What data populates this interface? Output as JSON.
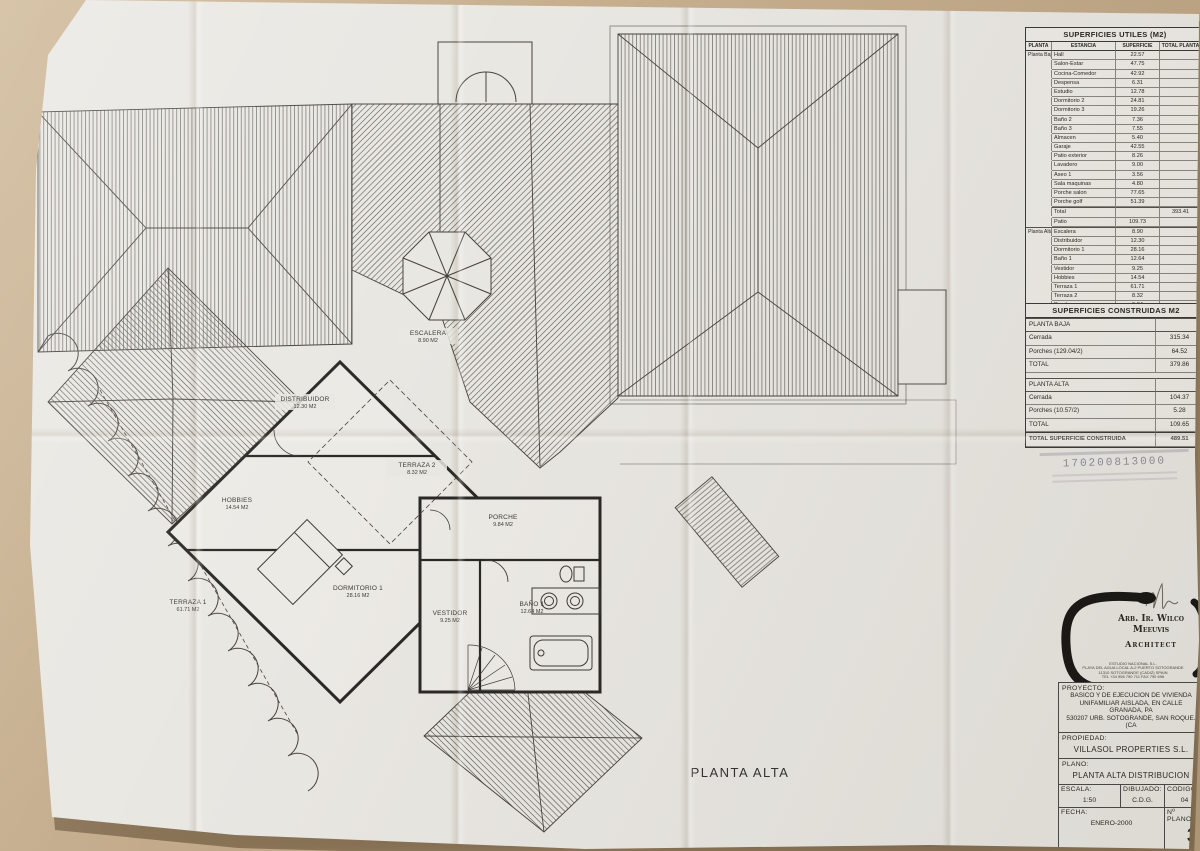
{
  "photo": {
    "background": "#c3ab8b",
    "paper": "#e9e7e2",
    "ink": "#45423c",
    "wall_ink": "#2b2926",
    "stamp_color": "#525470"
  },
  "plan": {
    "caption": "PLANTA ALTA",
    "rooms": [
      {
        "name": "DISTRIBUIDOR",
        "area": "12.30 M2"
      },
      {
        "name": "ESCALERA",
        "area": "8.90 M2"
      },
      {
        "name": "TERRAZA 2",
        "area": "8.32 M2"
      },
      {
        "name": "HOBBIES",
        "area": "14.54 M2"
      },
      {
        "name": "PORCHE",
        "area": "9.84 M2"
      },
      {
        "name": "DORMITORIO 1",
        "area": "28.16 M2"
      },
      {
        "name": "VESTIDOR",
        "area": "9.25 M2"
      },
      {
        "name": "BAÑO 1",
        "area": "12.64 M2"
      },
      {
        "name": "TERRAZA 1",
        "area": "61.71 M2"
      }
    ]
  },
  "superficies_utiles": {
    "title": "SUPERFICIES UTILES (M2)",
    "col_planta": "PLANTA",
    "col_estancia": "ESTANCIA",
    "col_superficie": "SUPERFICIE",
    "col_total": "TOTAL PLANTA",
    "planta_baja_label": "Planta Baja",
    "pb": [
      [
        "Hall",
        "22.57"
      ],
      [
        "Salon-Estar",
        "47.75"
      ],
      [
        "Cocina-Comedor",
        "42.92"
      ],
      [
        "Despensa",
        "6.31"
      ],
      [
        "Estudio",
        "12.78"
      ],
      [
        "Dormitorio 2",
        "24.81"
      ],
      [
        "Dormitorio 3",
        "19.26"
      ],
      [
        "Baño 2",
        "7.36"
      ],
      [
        "Baño 3",
        "7.55"
      ],
      [
        "Almacen",
        "5.40"
      ],
      [
        "Garaje",
        "42.55"
      ],
      [
        "Patio exterior",
        "8.26"
      ],
      [
        "Lavadero",
        "9.00"
      ],
      [
        "Aseo 1",
        "3.56"
      ],
      [
        "Sala maquinas",
        "4.80"
      ],
      [
        "Porche salon",
        "77.65"
      ],
      [
        "Porche golf",
        "51.39"
      ]
    ],
    "pb_total_label": "Total",
    "pb_total": "393.41",
    "patio_label": "Patio",
    "patio": "109.73",
    "planta_alta_label": "Planta Alta",
    "pa": [
      [
        "Escalera",
        "8.90"
      ],
      [
        "Distribuidor",
        "12.30"
      ],
      [
        "Dormitorio 1",
        "28.16"
      ],
      [
        "Baño 1",
        "12.64"
      ],
      [
        "Vestidor",
        "9.25"
      ],
      [
        "Hobbies",
        "14.54"
      ],
      [
        "Terraza 1",
        "61.71"
      ],
      [
        "Terraza 2",
        "8.32"
      ],
      [
        "Porche",
        "9.84"
      ]
    ],
    "pa_total_label": "Total",
    "pa_total": "165.66",
    "grand_label": "TOTAL SUPERFICIES UTILES",
    "grand": "553.18"
  },
  "superficies_construidas": {
    "title": "SUPERFICIES CONSTRUIDAS M2",
    "pb_header": "PLANTA BAJA",
    "pb_rows": [
      [
        "Cerrada",
        "315.34"
      ],
      [
        "Porches  (129.04/2)",
        "64.52"
      ]
    ],
    "pb_total_label": "TOTAL",
    "pb_total": "379.86",
    "pa_header": "PLANTA ALTA",
    "pa_rows": [
      [
        "Cerrada",
        "104.37"
      ],
      [
        "Porches  (10.57/2)",
        "5.28"
      ]
    ],
    "pa_total_label": "TOTAL",
    "pa_total": "109.65",
    "grand_label": "TOTAL SUPERFICIE CONSTRUIDA",
    "grand": "489.51"
  },
  "stamp": {
    "number": "170200813000"
  },
  "titleblock": {
    "architect_name": "Arb. Ir. Wilco Meeuvis",
    "architect_title": "Architect",
    "architect_info": "ESTUDIO NACIONAL S.L.\nPLAYA DEL AGUA LOCAL A-2 PUERTO SOTOGRANDE\n11310 SOTOGRANDE (CADIZ) SPAIN\nTEL +34 956 790 711  FAX 790 696",
    "proyecto_label": "PROYECTO:",
    "proyecto": "BASICO Y DE EJECUCION DE VIVIENDA\nUNIFAMILIAR AISLADA, EN CALLE GRANADA, PA\n530207 URB. SOTOGRANDE, SAN ROQUE. (CA",
    "propiedad_label": "PROPIEDAD:",
    "propiedad": "VILLASOL PROPERTIES S.L.",
    "plano_label": "PLANO:",
    "plano": "PLANTA ALTA DISTRIBUCION",
    "escala_label": "ESCALA:",
    "escala": "1:50",
    "dibujado_label": "DIBUJADO:",
    "dibujado": "C.D.G.",
    "codigo_label": "CODIGO:",
    "codigo": "04",
    "fecha_label": "FECHA:",
    "fecha": "ENERO-2000",
    "num_plano_label": "Nº PLANO:",
    "num_plano": "3"
  }
}
